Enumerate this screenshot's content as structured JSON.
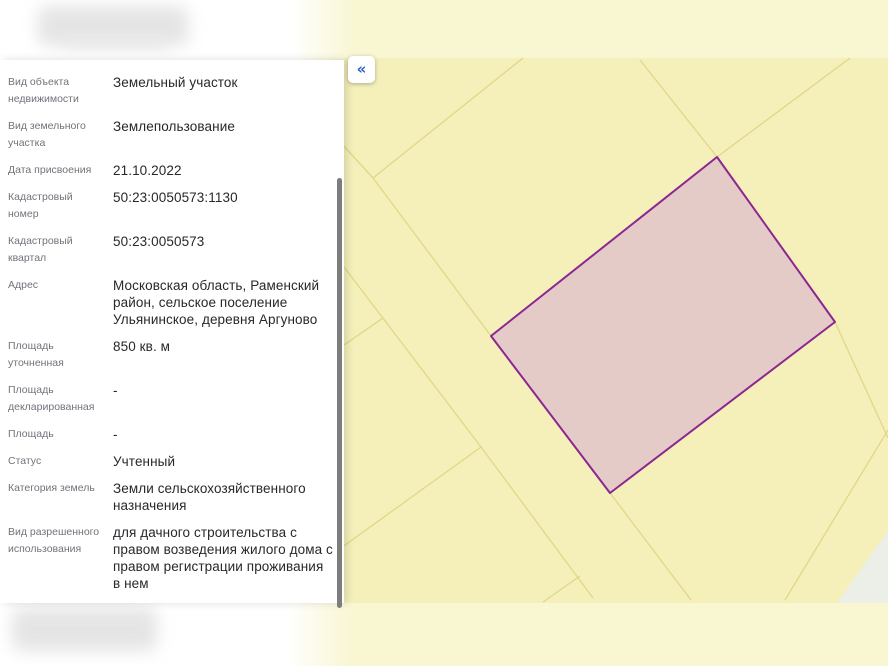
{
  "toolbar": {
    "collapse_button": "«"
  },
  "panel": {
    "fields": [
      {
        "label": "Вид объекта недвижимости",
        "value": "Земельный участок"
      },
      {
        "label": "Вид земельного участка",
        "value": "Землепользование"
      },
      {
        "label": "Дата присвоения",
        "value": "21.10.2022"
      },
      {
        "label": "Кадастровый номер",
        "value": "50:23:0050573:1130"
      },
      {
        "label": "Кадастровый квартал",
        "value": "50:23:0050573"
      },
      {
        "label": "Адрес",
        "value": "Московская область, Раменский район, сельское поселение Ульянинское, деревня Аргуново"
      },
      {
        "label": "Площадь уточненная",
        "value": "850 кв. м"
      },
      {
        "label": "Площадь декларированная",
        "value": "-"
      },
      {
        "label": "Площадь",
        "value": "-"
      },
      {
        "label": "Статус",
        "value": "Учтенный"
      },
      {
        "label": "Категория земель",
        "value": "Земли сельскохозяйственного назначения"
      },
      {
        "label": "Вид разрешенного использования",
        "value": "для дачного строительства с правом возведения жилого дома с правом регистрации проживания в нем"
      },
      {
        "label": "Форма собственности",
        "value": "Частная"
      },
      {
        "label": "Кадастровая стоимость",
        "value": "397 485,5 руб."
      }
    ]
  },
  "map": {
    "size": {
      "width": 888,
      "height": 666
    },
    "colors": {
      "background": "#f5f0ba",
      "strip": "#f9f6d2",
      "boundary_line": "#e2d687",
      "parcel_fill": "#e5cbc8",
      "parcel_stroke": "#8c2690",
      "no_data_fill": "#eceee8"
    },
    "strips": [
      {
        "x": 0,
        "y": 0,
        "w": 888,
        "h": 58
      },
      {
        "x": 0,
        "y": 603,
        "w": 888,
        "h": 63
      }
    ],
    "boundary_lines": [
      [
        523,
        58,
        373,
        178
      ],
      [
        341,
        143,
        373,
        178
      ],
      [
        373,
        178,
        491,
        336
      ],
      [
        344,
        267,
        481,
        447
      ],
      [
        383,
        318,
        341,
        347
      ],
      [
        481,
        447,
        341,
        548
      ],
      [
        481,
        447,
        593,
        598
      ],
      [
        543,
        602,
        580,
        576
      ],
      [
        640,
        60,
        717,
        157
      ],
      [
        850,
        58,
        717,
        157
      ],
      [
        835,
        322,
        888,
        438
      ],
      [
        888,
        430,
        785,
        600
      ],
      [
        610,
        493,
        691,
        600
      ]
    ],
    "no_data_triangle": [
      [
        888,
        531
      ],
      [
        837,
        603
      ],
      [
        888,
        603
      ]
    ],
    "parcel_polygon": [
      [
        717,
        157
      ],
      [
        835,
        322
      ],
      [
        610,
        493
      ],
      [
        491,
        336
      ]
    ]
  }
}
